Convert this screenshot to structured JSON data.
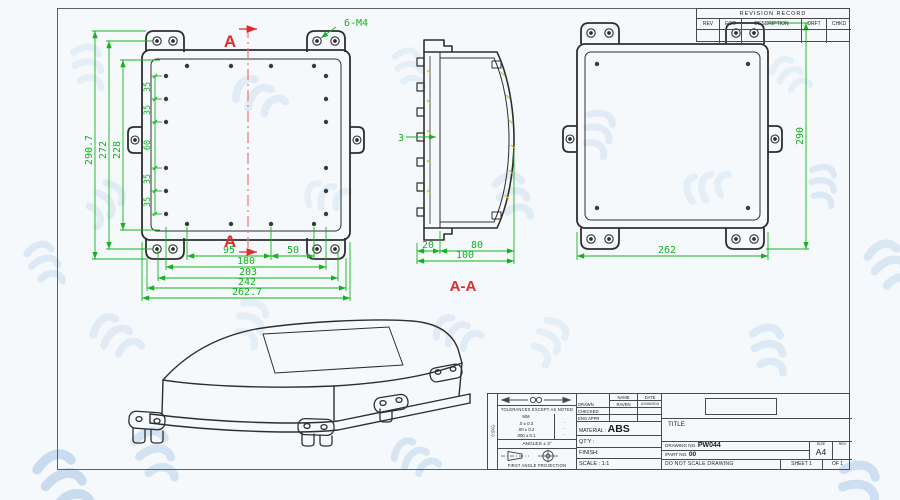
{
  "colors": {
    "dim_green": "#12b31c",
    "section_red": "#e02b2b",
    "line_dark": "#2e2e2e",
    "hatch_yellow": "#cdbf1e",
    "watermark": "#dfe9f4"
  },
  "revision_table": {
    "title": "REVISION RECORD",
    "columns": [
      "REV",
      "ECO",
      "DESCRIPTION",
      "DRFT",
      "CHKD"
    ]
  },
  "front_view": {
    "section_label": "A",
    "thread_callout": "6-M4",
    "dim_overall_h": "290.7",
    "dim_h2": "272",
    "dim_h3": "228",
    "chain": [
      "35",
      "35",
      "60",
      "35",
      "35"
    ],
    "dim_95": "95",
    "dim_50": "50",
    "dim_180": "180",
    "dim_203": "203",
    "dim_242": "242",
    "dim_overall_w": "262.7"
  },
  "section_view": {
    "label": "A-A",
    "wall": "3",
    "dim_20": "20",
    "dim_80": "80",
    "dim_100": "100"
  },
  "back_view": {
    "height": "290",
    "width": "262"
  },
  "title_block": {
    "strip_note": "0.5KG",
    "tolerance_header": "TOLERANCES EXCEPT AS NOTED",
    "tolerance_unit": "MM",
    "tolerance_rows": [
      ".0 ± 0.3",
      ".00 ± 0.2",
      ".000 ± 0.1"
    ],
    "tolerance_marks": [
      "·",
      "·",
      "·"
    ],
    "angles": "ANGLES ± 3°",
    "projection": "FIRST ANGLE PROJECTION",
    "name_col": "NAME",
    "date_col": "DATE",
    "rows": [
      {
        "label": "DRAWN",
        "name": "RAVEN",
        "date": "01/05/2015"
      },
      {
        "label": "CHECKED",
        "name": "",
        "date": ""
      },
      {
        "label": "ENG APPR",
        "name": "",
        "date": ""
      }
    ],
    "material_label": "MATERIAL :",
    "material_value": "ABS",
    "qty_label": "QT'Y :",
    "finish_label": "FINISH:",
    "scale_label": "SCALE : 1:1",
    "title_label": "TITLE",
    "drawing_no_label": "DRAWING NO.",
    "drawing_no": "PW044",
    "part_no_label": "/PART NO.",
    "part_no": "00",
    "size_label": "SIZE",
    "size_value": "A4",
    "rev_label": "REV",
    "do_not_scale": "DO NOT SCALE DRAWING",
    "sheet_label": "SHEET",
    "sheet_no": "1",
    "of_label": "OF",
    "of_no": "1"
  }
}
